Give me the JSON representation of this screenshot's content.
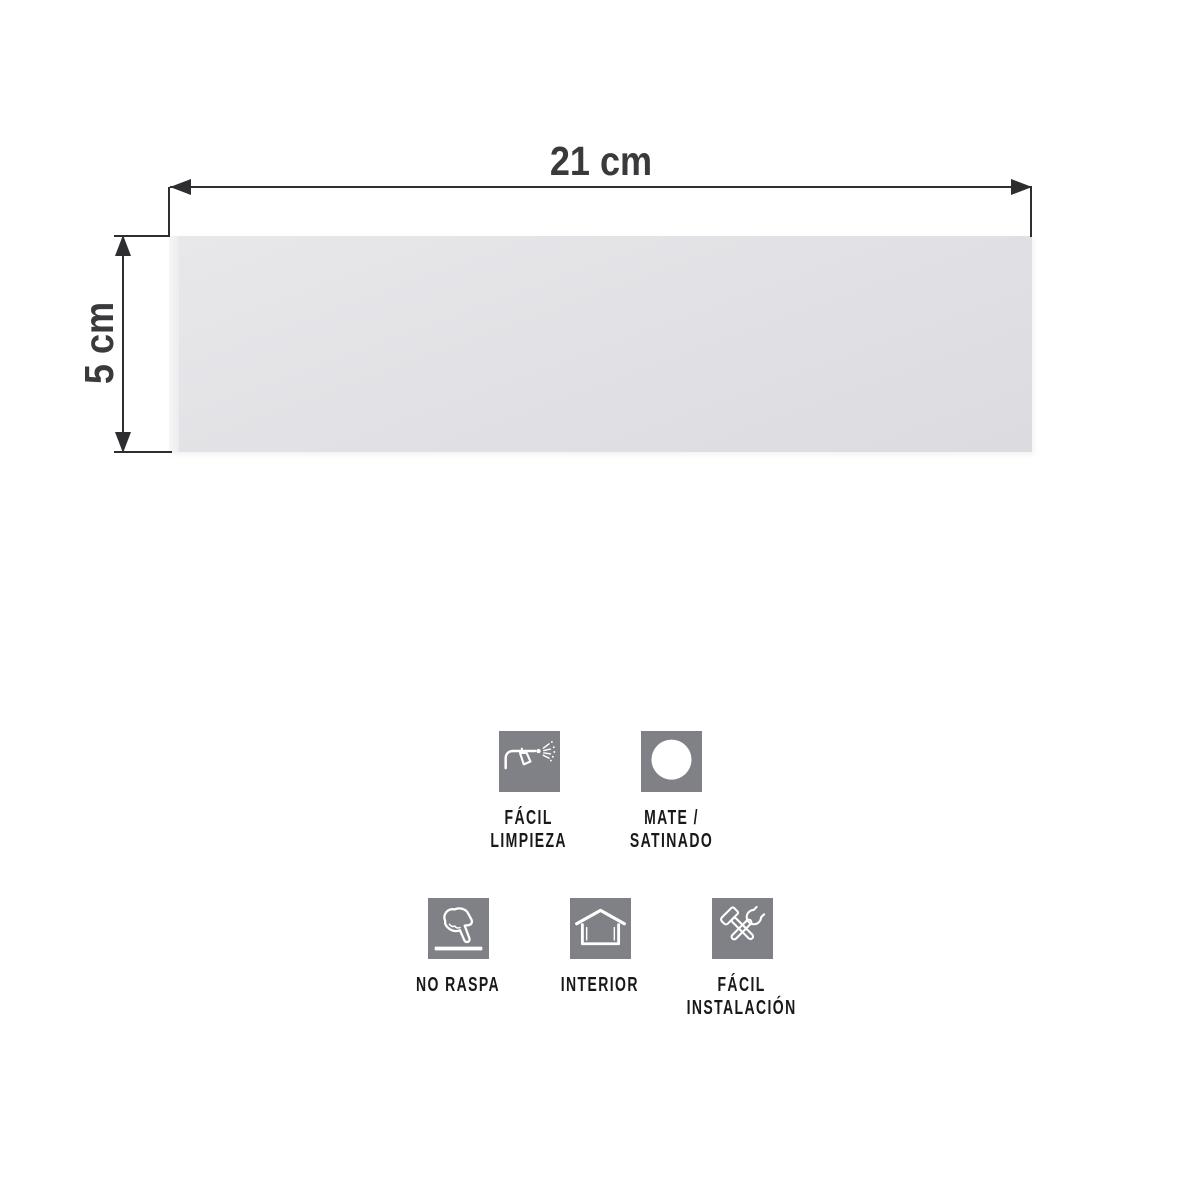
{
  "diagram": {
    "width_label": "21 cm",
    "height_label": "5 cm",
    "line_color": "#2e2e30",
    "label_color": "#3a3a3d",
    "tile_color": "#e2e2e6",
    "tile_edge_color": "#f4f4f5"
  },
  "features": {
    "icon_bg_color": "#808186",
    "icon_fg_color": "#ffffff",
    "label_color": "#191919",
    "items": [
      {
        "icon": "spray-gun-icon",
        "lines": [
          "FÁCIL",
          "LIMPIEZA"
        ]
      },
      {
        "icon": "matte-circle-icon",
        "lines": [
          "MATE /",
          "SATINADO"
        ]
      },
      {
        "icon": "pointing-hand-icon",
        "lines": [
          "NO RASPA"
        ]
      },
      {
        "icon": "house-icon",
        "lines": [
          "INTERIOR"
        ]
      },
      {
        "icon": "tools-icon",
        "lines": [
          "FÁCIL",
          "INSTALACIÓN"
        ]
      }
    ]
  }
}
